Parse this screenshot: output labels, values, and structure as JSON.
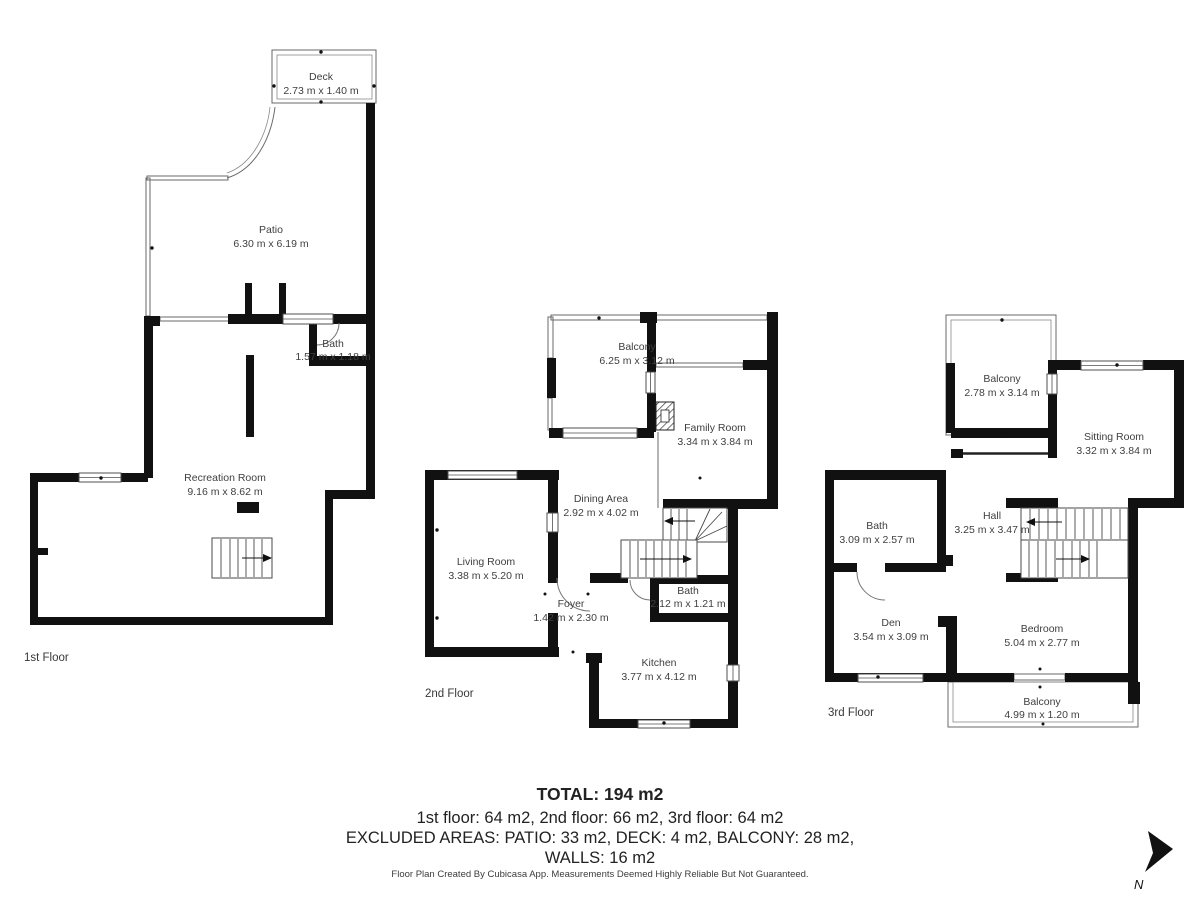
{
  "floors": [
    {
      "label": "1st Floor",
      "rooms": [
        {
          "name": "Deck",
          "dims": "2.73 m x 1.40 m"
        },
        {
          "name": "Patio",
          "dims": "6.30 m x 6.19 m"
        },
        {
          "name": "Bath",
          "dims": "1.57 m x 1.18 m"
        },
        {
          "name": "Recreation Room",
          "dims": "9.16 m x 8.62 m"
        }
      ]
    },
    {
      "label": "2nd Floor",
      "rooms": [
        {
          "name": "Balcony",
          "dims": "6.25 m x 3.12 m"
        },
        {
          "name": "Family Room",
          "dims": "3.34 m x 3.84 m"
        },
        {
          "name": "Dining Area",
          "dims": "2.92 m x 4.02 m"
        },
        {
          "name": "Living Room",
          "dims": "3.38 m x 5.20 m"
        },
        {
          "name": "Foyer",
          "dims": "1.42 m x 2.30 m"
        },
        {
          "name": "Bath",
          "dims": "2.12 m x 1.21 m"
        },
        {
          "name": "Kitchen",
          "dims": "3.77 m x 4.12 m"
        }
      ]
    },
    {
      "label": "3rd Floor",
      "rooms": [
        {
          "name": "Balcony",
          "dims": "2.78 m x 3.14 m"
        },
        {
          "name": "Sitting Room",
          "dims": "3.32 m x 3.84 m"
        },
        {
          "name": "Bath",
          "dims": "3.09 m x 2.57 m"
        },
        {
          "name": "Hall",
          "dims": "3.25 m x 3.47 m"
        },
        {
          "name": "Den",
          "dims": "3.54 m x 3.09 m"
        },
        {
          "name": "Bedroom",
          "dims": "5.04 m x 2.77 m"
        },
        {
          "name": "Balcony",
          "dims": "4.99 m x 1.20 m"
        }
      ]
    }
  ],
  "summary": {
    "total": "TOTAL: 194 m2",
    "floors_line": "1st floor: 64 m2, 2nd floor: 66 m2, 3rd floor: 64 m2",
    "excluded_line": "EXCLUDED AREAS: PATIO: 33 m2, DECK: 4 m2, BALCONY: 28 m2,",
    "walls_line": "WALLS: 16 m2"
  },
  "footer": "Floor Plan Created By Cubicasa App. Measurements Deemed Highly Reliable But Not Guaranteed.",
  "compass": {
    "label": "N"
  },
  "colors": {
    "wall": "#111111",
    "thin_line": "#6a6a6a",
    "label_text": "#3f3f3f",
    "summary_text": "#222222"
  }
}
